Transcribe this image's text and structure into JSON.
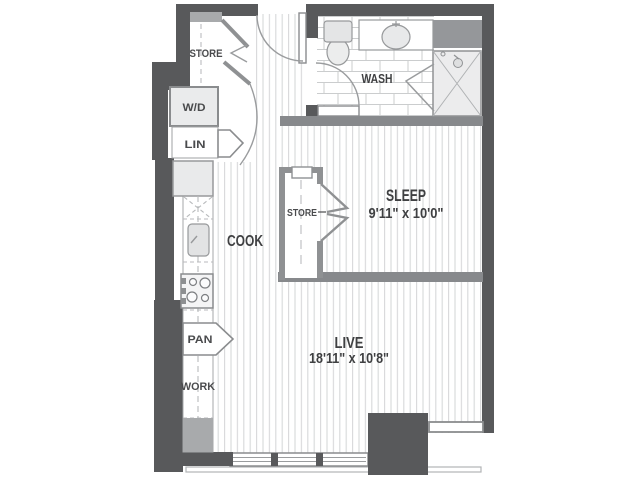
{
  "floorplan": {
    "rooms": {
      "cook": {
        "label": "COOK"
      },
      "wash": {
        "label": "WASH"
      },
      "sleep": {
        "label": "SLEEP",
        "dimensions": "9'11\" x 10'0\""
      },
      "live": {
        "label": "LIVE",
        "dimensions": "18'11\" x 10'8\""
      }
    },
    "closets": {
      "entry_store": {
        "label": "STORE"
      },
      "washer_dryer": {
        "label": "W/D"
      },
      "linen": {
        "label": "LIN"
      },
      "bedroom_store": {
        "label": "STORE"
      },
      "pantry": {
        "label": "PAN"
      },
      "work": {
        "label": "WORK"
      }
    },
    "fixtures": [
      "toilet",
      "bathroom-sink",
      "shower",
      "utility-shaft",
      "kitchen-sink",
      "stove",
      "refrigerator",
      "dishwasher",
      "windows",
      "balcony-edge",
      "entry-door",
      "bathroom-door"
    ],
    "colors": {
      "wall_dark": "#58595b",
      "wall_light": "#87898c",
      "closet_wall": "#8f9193",
      "floor": "#ffffff",
      "hatch_line": "#d7d8d9",
      "tile_line": "#cbcdce",
      "fixture_fill": "#e9eaeb",
      "shaft_gray": "#95979a",
      "cabinet_gray": "#a8aaac",
      "text": "#3f4042"
    }
  }
}
